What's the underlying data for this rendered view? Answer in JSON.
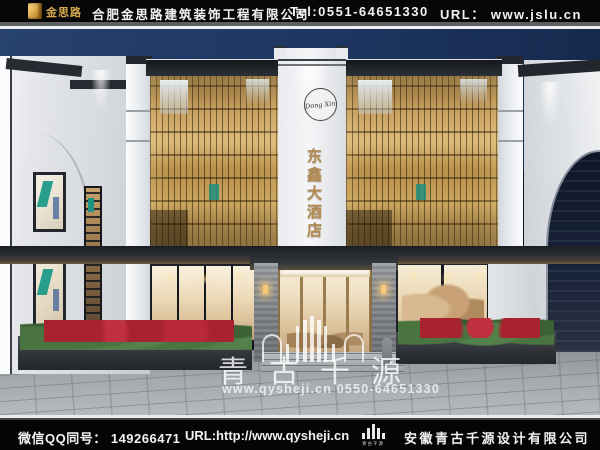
{
  "header": {
    "logo_text": "金思路",
    "company": "合肥金思路建筑装饰工程有限公司",
    "tel": "Tel:0551-64651330",
    "url": "URL：  www.jslu.cn"
  },
  "building": {
    "circle_logo_text": "Dong Xin",
    "sign": "东鑫大酒店"
  },
  "watermark": {
    "brand": "青古千源",
    "contact": "www.qysheji.cn  0550-64651330"
  },
  "footer": {
    "qq": "微信QQ同号： 149266471",
    "url": "URL:http://www.qysheji.cn",
    "logo_caption": "青古千源",
    "company": "安徽青古千源设计有限公司"
  },
  "colors": {
    "bar_bg": "#070707",
    "sky_blue": "#1f3864",
    "gold_screen": "#b8904a",
    "sign_gold": "#b28b52",
    "teal_accent": "#1f9a88",
    "warm_interior": "#eedcba"
  }
}
